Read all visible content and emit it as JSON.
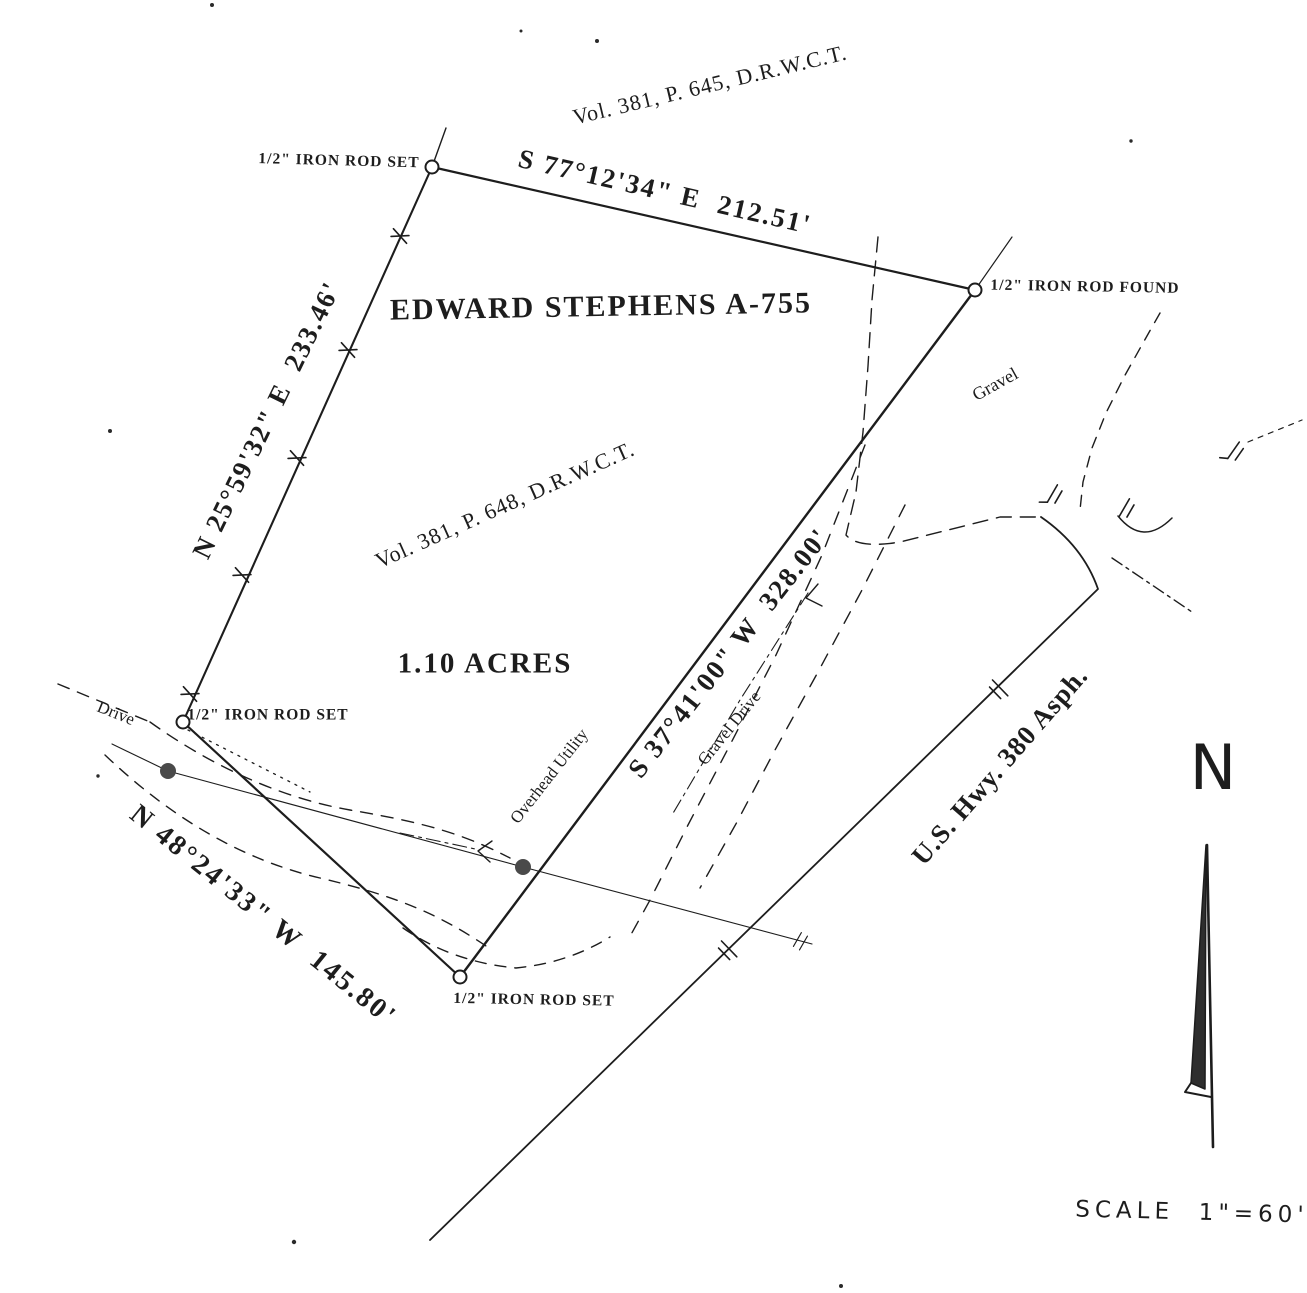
{
  "labels": {
    "record_top": "Vol. 381, P. 645, D.R.W.C.T.",
    "bearing_north": "S 77°12'34\" E  212.51'",
    "monument_nw": "1/2\" IRON ROD SET",
    "monument_ne": "1/2\" IRON ROD FOUND",
    "survey_name": "EDWARD STEPHENS A-755",
    "bearing_west": "N 25°59'32\" E  233.46'",
    "record_inner": "Vol. 381, P. 648, D.R.W.C.T.",
    "area": "1.10 ACRES",
    "gravel": "Gravel",
    "bearing_east": "S 37°41'00\" W  328.00'",
    "gravel_drive": "Gravel Drive",
    "overhead_utility": "Overhead Utility",
    "highway": "U.S. Hwy. 380 Asph.",
    "drive": "Drive",
    "bearing_south": "N 48°24'33\" W  145.80'",
    "monument_w": "1/2\" IRON ROD SET",
    "monument_s": "1/2\" IRON ROD SET",
    "north_letter": "N",
    "scale": "SCALE  1\"=60'"
  },
  "monuments": {
    "northwest": "1/2 inch iron rod set",
    "northeast": "1/2 inch iron rod found",
    "west": "1/2 inch iron rod set",
    "south": "1/2 inch iron rod set"
  },
  "parcel": {
    "area_acres": "1.10",
    "survey": "EDWARD STEPHENS A-755",
    "sides": [
      {
        "side": "north",
        "bearing": "S 77°12'34\" E",
        "distance_ft": "212.51"
      },
      {
        "side": "west",
        "bearing": "N 25°59'32\" E",
        "distance_ft": "233.46"
      },
      {
        "side": "east",
        "bearing": "S 37°41'00\" W",
        "distance_ft": "328.00"
      },
      {
        "side": "south",
        "bearing": "N 48°24'33\" W",
        "distance_ft": "145.80"
      }
    ]
  },
  "colors": {
    "ink": "#1d1d1d",
    "paper": "#ffffff",
    "pole": "#4a4a4a"
  }
}
